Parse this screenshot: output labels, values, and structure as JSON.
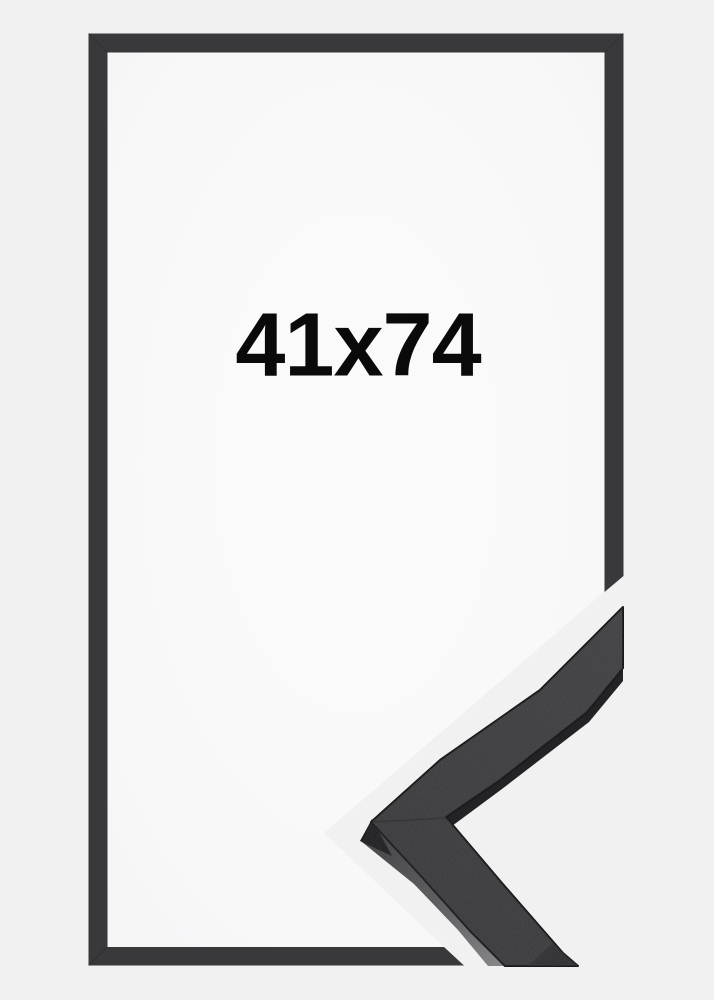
{
  "product": {
    "size_label": "41x74"
  },
  "colors": {
    "background": "#f1f1f2",
    "inner_area_center": "#fbfbfb",
    "inner_area_edge": "#f5f5f6",
    "frame_outline": "#39393b",
    "profile_face": "#3a3a3c",
    "profile_edge": "#18181a",
    "profile_side_light": "#828285",
    "profile_side_mid": "#4a4a4c",
    "profile_side_dark": "#232325",
    "label_text": "#0a0a0b"
  }
}
